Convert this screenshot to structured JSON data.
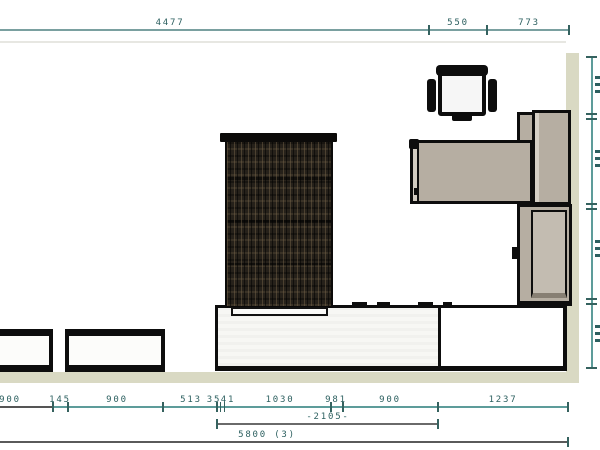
{
  "drawing": {
    "type": "interior-plan-with-dimensions",
    "canvas": {
      "width": 600,
      "height": 450
    },
    "colors": {
      "dimension_line_teal": "#5d9c9a",
      "dimension_line_gray": "#5a5a5a",
      "dimension_text": "#2d6060",
      "wall": "#d9d9c3",
      "furniture_fill": "#b6aea2",
      "furniture_outline": "#0d0d0d",
      "textured_panel": "#26211a",
      "counter_fill": "#f3f3f0"
    },
    "dimensions": {
      "top": {
        "orientation": "horizontal",
        "y": 30,
        "x1": 0,
        "x2": 570,
        "color": "#7aa0a0",
        "ticks": [
          429,
          487,
          569
        ],
        "labels": [
          {
            "text": "4477",
            "x": 170
          },
          {
            "text": "550",
            "x": 458
          },
          {
            "text": "773",
            "x": 529
          }
        ]
      },
      "bottom_row1": {
        "orientation": "horizontal",
        "y": 407,
        "x1": 0,
        "x2": 569,
        "color": "#5d9c9a",
        "segments": [
          {
            "x1": 0,
            "x2": 53,
            "color": "#555555"
          }
        ],
        "ticks": [
          53,
          68,
          163,
          217,
          220.5,
          224.5,
          331,
          343,
          438,
          568
        ],
        "labels": [
          {
            "text": "900",
            "x": 10
          },
          {
            "text": "145",
            "x": 60
          },
          {
            "text": "900",
            "x": 117
          },
          {
            "text": "513",
            "x": 191
          },
          {
            "text": "35",
            "x": 214
          },
          {
            "text": "41",
            "x": 228
          },
          {
            "text": "1030",
            "x": 280
          },
          {
            "text": "981",
            "x": 336
          },
          {
            "text": "900",
            "x": 390
          },
          {
            "text": "1237",
            "x": 503
          }
        ]
      },
      "bottom_row2": {
        "orientation": "horizontal",
        "y": 424,
        "x1": 217,
        "x2": 438,
        "color": "#6a6a6a",
        "ticks": [
          217,
          438
        ],
        "labels": [
          {
            "text": "-2105-",
            "x": 328
          }
        ]
      },
      "bottom_row3": {
        "orientation": "horizontal",
        "y": 442,
        "x1": 0,
        "x2": 569,
        "color": "#5a5a5a",
        "ticks": [
          568
        ],
        "labels": [
          {
            "text": "5800 (3)",
            "x": 267
          }
        ]
      },
      "right_vertical": {
        "orientation": "vertical",
        "x": 592,
        "y1": 57,
        "y2": 369,
        "color": "#5d9c9a",
        "ticks": [
          57,
          114,
          119,
          204,
          209,
          299,
          304,
          368
        ],
        "edge_text_fragments_y": [
          76,
          150,
          240,
          325
        ]
      }
    },
    "objects": [
      {
        "name": "table-1"
      },
      {
        "name": "table-2"
      },
      {
        "name": "textured-cabinet"
      },
      {
        "name": "sideboard-counter"
      },
      {
        "name": "desk"
      },
      {
        "name": "office-chair"
      },
      {
        "name": "wall-cabinet-shelf"
      },
      {
        "name": "wall-cabinet-upper"
      },
      {
        "name": "wall-cabinet-lower"
      },
      {
        "name": "wall-right"
      },
      {
        "name": "wall-bottom"
      }
    ]
  }
}
